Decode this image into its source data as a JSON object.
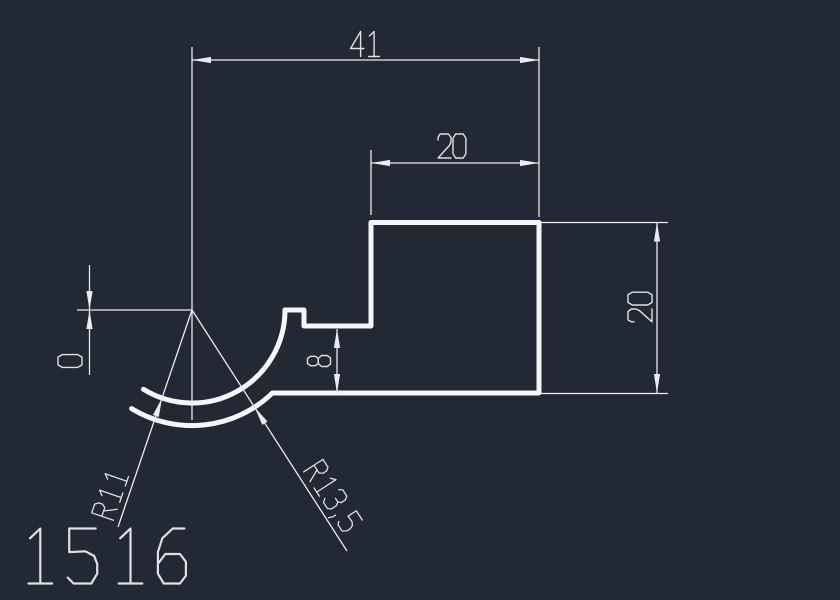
{
  "app": {
    "view": "cad-drawing-viewport"
  },
  "colors": {
    "background": "#232934",
    "geometry": "#f4f6f9",
    "dimension_lines": "#e8ecf2",
    "text": "#dce1e8"
  },
  "drawing": {
    "part_number": "1516",
    "dimensions": {
      "width_total": "41",
      "width_top": "20",
      "height_right": "20",
      "height_step": "8",
      "offset_zero": "0",
      "radius_inner": "R11",
      "radius_outer": "R13,5"
    }
  }
}
